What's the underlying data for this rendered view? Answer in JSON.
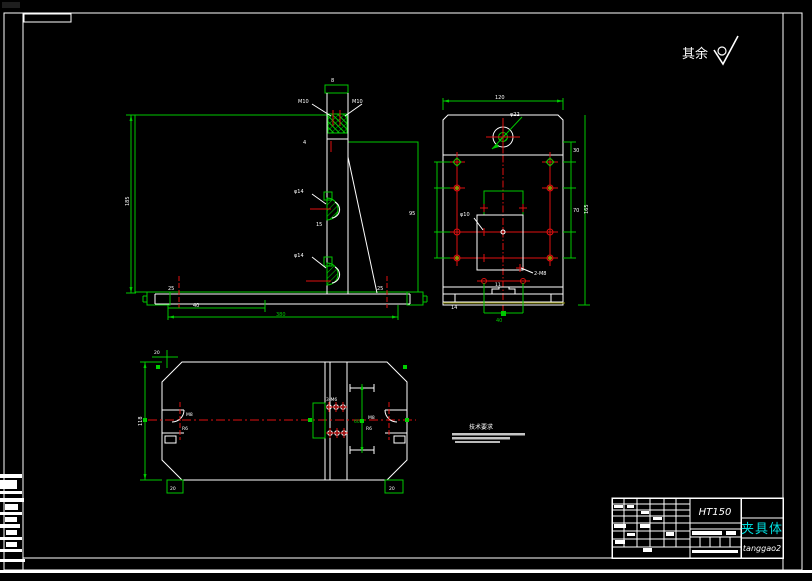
{
  "surface_finish": {
    "label": "其余"
  },
  "notes": {
    "title": "技术要求"
  },
  "title_block": {
    "material": "HT150",
    "part_name": "夹具体",
    "drafter": "tanggao2"
  },
  "colors": {
    "background": "#000000",
    "line_green": "#00c800",
    "line_white": "#ffffff",
    "line_red": "#e01010",
    "line_yellow": "#8f8f00",
    "accent_cyan": "#00dede"
  },
  "dims": {
    "front": {
      "cap": "8",
      "leader_left": "M10",
      "leader_right": "M10",
      "web": "4",
      "boss_top": "φ14",
      "boss_bottom": "φ14",
      "mid": "15",
      "foot_left": "25",
      "foot_right": "25",
      "base_inner": "40",
      "base_total": "380",
      "height": "185",
      "right_height": "95"
    },
    "side": {
      "width_top": "120",
      "bore": "φ22",
      "hole_mid": "φ10",
      "thread": "2-M8",
      "row1": "30",
      "row2": "70",
      "height_right": "165",
      "foot": "14",
      "step": "11",
      "slot_width": "40"
    },
    "plan": {
      "depth": "118",
      "chamfer": "20",
      "foot_left": "20",
      "foot_right": "20",
      "holes": "3-M6",
      "slot_left_1": "M8",
      "slot_left_2": "R6",
      "slot_right_1": "M8",
      "slot_right_2": "R6",
      "rib": "60"
    }
  }
}
